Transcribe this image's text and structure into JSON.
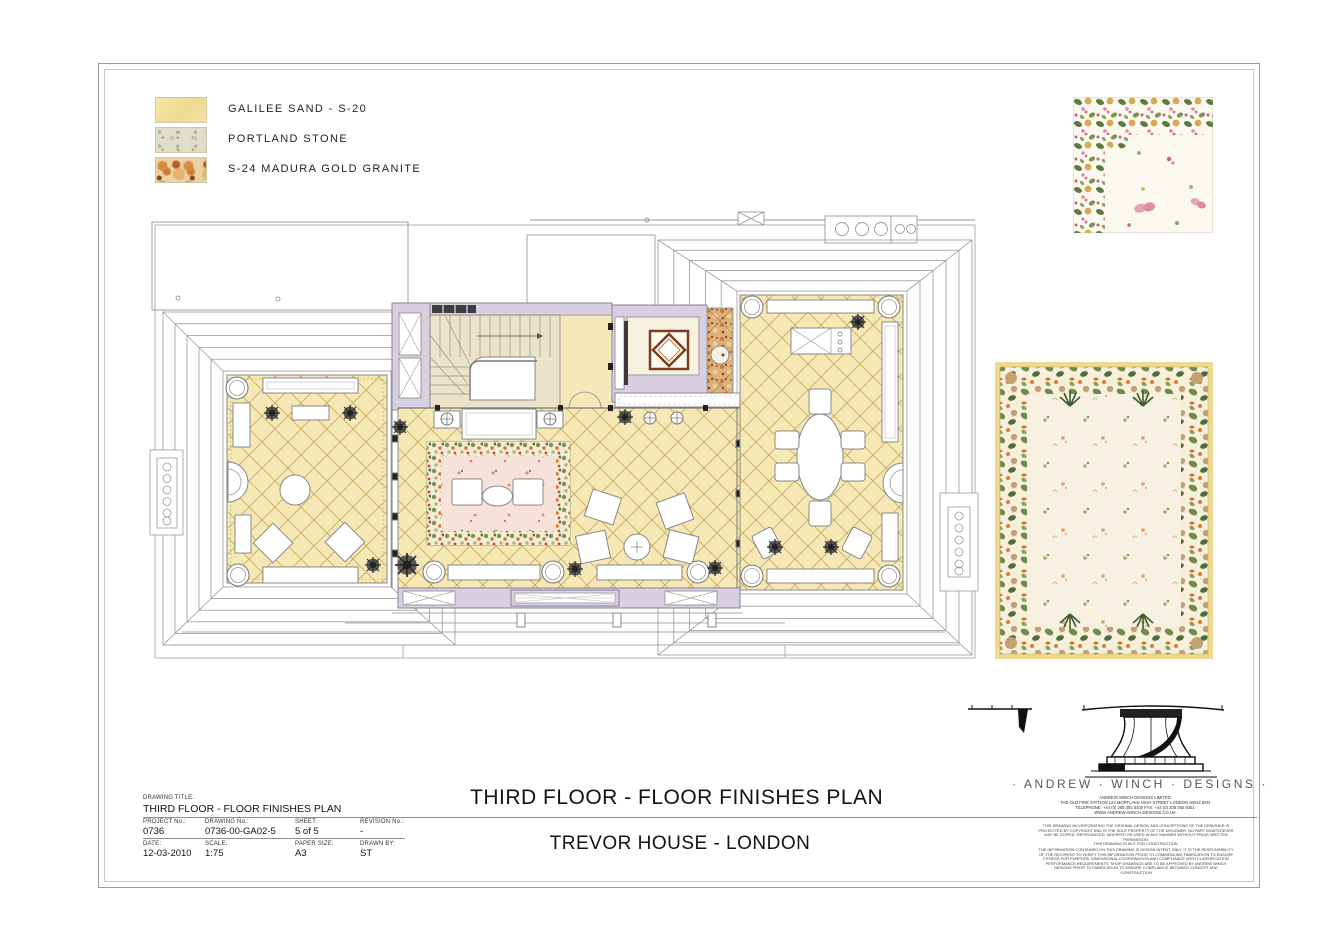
{
  "legend": {
    "items": [
      {
        "name": "galilee-sand",
        "label": "GALILEE SAND - S-20",
        "color": "#f3e1a0"
      },
      {
        "name": "portland-stone",
        "label": "PORTLAND STONE",
        "color": "#e0ddcb"
      },
      {
        "name": "madura-gold-granite",
        "label": "S-24 MADURA GOLD GRANITE",
        "color": "#d98a3f"
      }
    ]
  },
  "titles": {
    "plan_title": "THIRD FLOOR - FLOOR FINISHES PLAN",
    "project_title": "TREVOR HOUSE - LONDON"
  },
  "title_block": {
    "drawing_title_label": "DRAWING TITLE:",
    "drawing_title": "THIRD FLOOR - FLOOR FINISHES PLAN",
    "fields": [
      {
        "label": "PROJECT No.:",
        "value": "0736"
      },
      {
        "label": "DRAWING No.:",
        "value": "0736-00-GA02-5"
      },
      {
        "label": "SHEET:",
        "value": "5 of 5"
      },
      {
        "label": "REVISION No.:",
        "value": "-"
      },
      {
        "label": "DATE:",
        "value": "12-03-2010"
      },
      {
        "label": "SCALE:",
        "value": "1:75"
      },
      {
        "label": "PAPER SIZE:",
        "value": "A3"
      },
      {
        "label": "DRAWN BY:",
        "value": "ST"
      }
    ]
  },
  "brand": {
    "logo_text": "· ANDREW · WINCH · DESIGNS ·",
    "company": "ANDREW WINCH DESIGNS LIMITED",
    "address": "THE OLD FIRE STATION 123 MORTLAKE HIGH STREET LONDON SW14 8SN",
    "phone": "TELEPHONE: +44 (0) 208 392 8400 FAX: +44 (0) 208 392 8401",
    "website": "WWW.ANDREW-WINCH-DESIGNS.CO.UK",
    "disclaimer1": "THIS DRAWING INCORPORATING THE ORIGINAL DESIGN AND CONCEPTIONS OF THE DESIGNER IS PROTECTED BY COPYRIGHT AND IS THE SOLE PROPERTY OF THE DESIGNER. NO PART WHATSOEVER MAY BE COPIED, REPRODUCED, MODIFIED OR USED IN ANY MANNER WITHOUT PRIOR WRITTEN PERMISSION.",
    "disclaimer2": "THIS DRAWING IS NOT FOR CONSTRUCTION.",
    "disclaimer3": "THE INFORMATION CONTAINED ON THIS DRAWING IS DESIGN INTENT ONLY. IT IS THE RESPONSIBILITY OF THE RECIPIENT TO VERIFY THIS INFORMATION PRIOR TO COMMENCING FABRICATION TO ENSURE FITNESS FOR PURPOSE, DIMENSIONAL COORDINATION AND COMPLIANCE WITH CLASSIFICATION PERFORMANCE REQUIREMENTS. SHOP DRAWINGS ARE TO BE APPROVED BY ANDREW WINCH DESIGNS PRIOR TO FABRICATION TO ENSURE COMPLIANCE BETWEEN CONCEPT AND CONSTRUCTION"
  },
  "colors": {
    "floor_galilee_sand": "#f5e8b5",
    "lattice_line": "#c4a85e",
    "wall_lavender": "#d9cfe2",
    "carpet_field_pink": "#f6e2d8",
    "granite_base": "#dfae79",
    "wood_inlay": "#7a3f1f",
    "stair_beige": "#eae3ca",
    "outline_gray": "#9a9a9a"
  }
}
